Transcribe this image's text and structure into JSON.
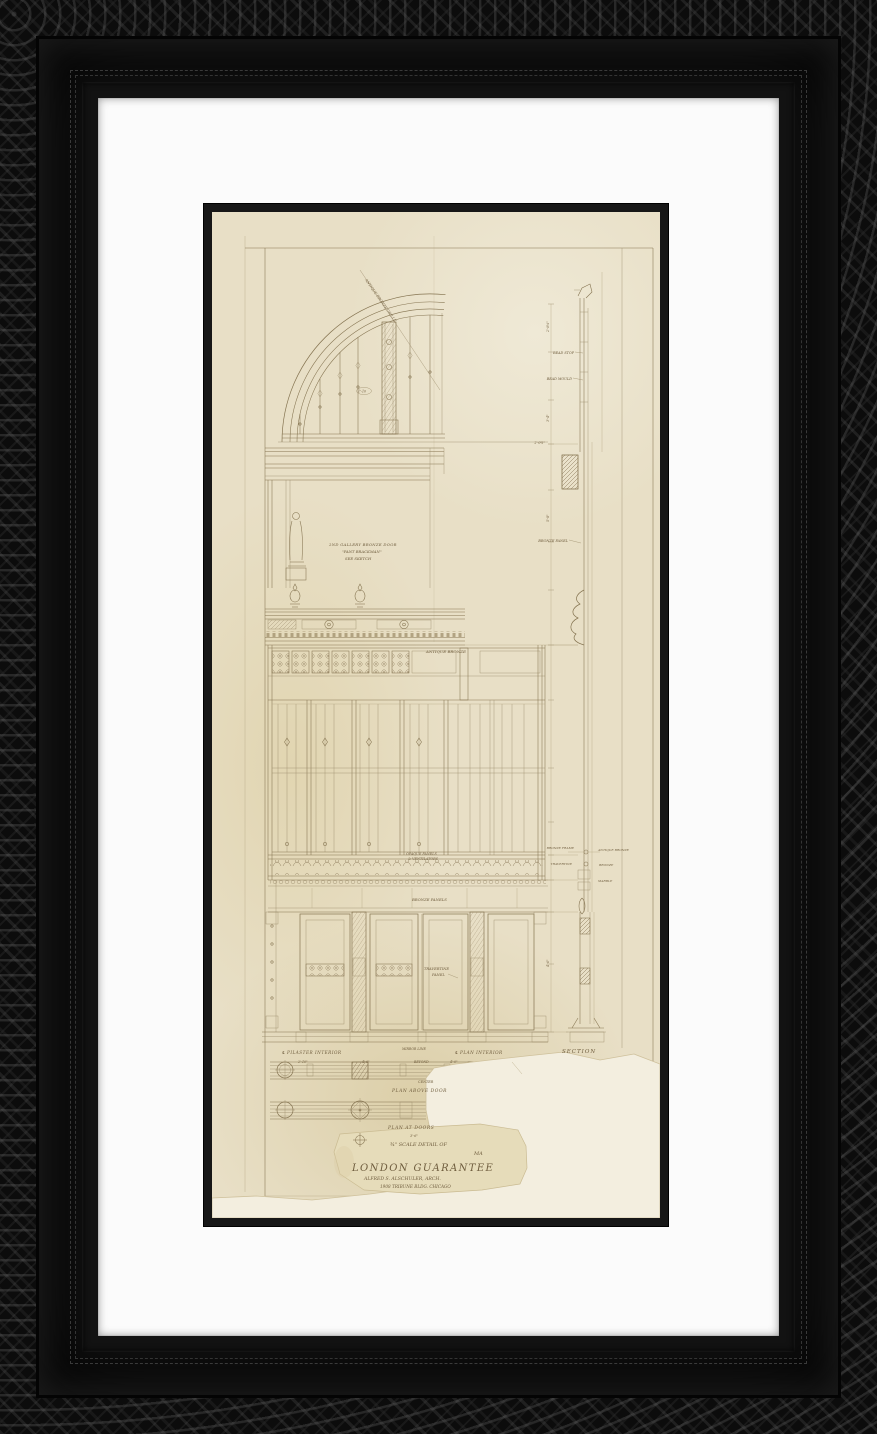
{
  "frame": {
    "style_color": "#0d0d0d",
    "mat_color": "#fbfbfb",
    "fillet_color": "#171717",
    "paper_color": "#e8dfc6",
    "ink_color": "#857451"
  },
  "labels": {
    "arch_note": "ANTIQUE BRONZE GRILLE",
    "arch_dim": "1'-10",
    "gallery_1": "2ND GALLERY BRONZE DOOR",
    "gallery_2": "\"PANT BRACKMAN\"",
    "gallery_3": "SEE SKETCH",
    "bead_1": "BEAD STOP",
    "bead_2": "BEAD MOULD",
    "dim_small_1": "2'-0½\"",
    "bronze_panel": "BRONZE PANEL",
    "antique_bronze": "ANTIQUE BRONZE",
    "opaque_1": "OPAQUE PANELS",
    "opaque_2": "& VENTILATORS",
    "bronze_panels": "BRONZE PANELS",
    "travertine_1": "TRAVERTINE",
    "travertine_2": "PANEL",
    "cl_pilaster": "℄ PILASTER INTERIOR",
    "mirror_line": "MIRROR LINE",
    "beyond": "BEYOND",
    "cl_plan": "℄ PLAN INTERIOR",
    "section": "SECTION",
    "center": "CENTER",
    "plan_above": "PLAN ABOVE DOOR",
    "plan_at": "PLAN AT DOORS",
    "dim_36": "3'-6\"",
    "dim_210": "2'-10\"",
    "dim_46": "4'-6\"",
    "dim_40": "4'-0\"",
    "sec_left_1": "BRONZE FRAME",
    "sec_left_2": "TRAVERTINE",
    "sec_right_1": "ANTIQUE BRONZE",
    "sec_right_2": "BRONZE",
    "sec_right_3": "MARBLE",
    "dim_rot_1": "2'-0⅜\"",
    "dim_rot_2": "3'-4\"",
    "dim_rot_3": "5'-8\"",
    "dim_rot_4": "4'-6\"",
    "title_scale": "¾\" SCALE DETAIL OF",
    "title_ma": "MA",
    "title_main": "LONDON GUARANTEE",
    "title_arch": "ALFRED S. ALSCHULER, ARCH.",
    "title_addr": "1908 TRIBUNE BLDG. CHICAGO"
  }
}
